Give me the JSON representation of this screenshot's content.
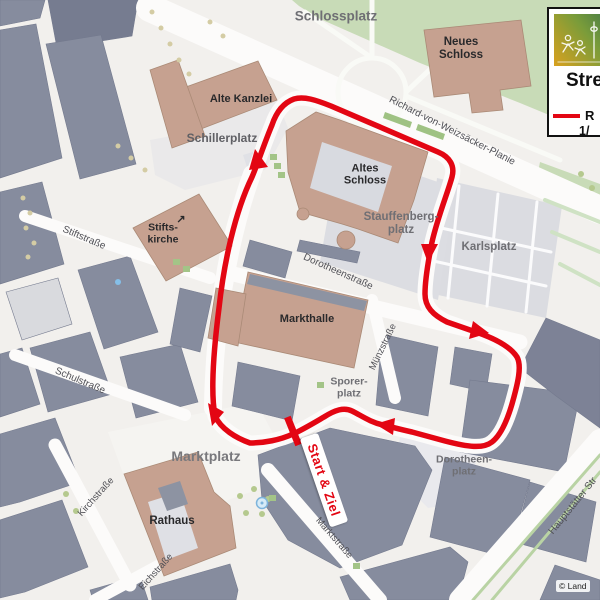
{
  "legend": {
    "logo": "stuttgart-lauf-logo",
    "title": "Stre",
    "route_item": "R",
    "route_item2": "1/",
    "line_color": "#e30613"
  },
  "map": {
    "copyright": "© Land",
    "route_color": "#e30613",
    "start_finish": "Start & Ziel",
    "places": {
      "schlossplatz": "Schlossplatz",
      "neues_schloss": {
        "l1": "Neues",
        "l2": "Schloss"
      },
      "alte_kanzlei": "Alte Kanzlei",
      "schillerplatz": "Schillerplatz",
      "altes_schloss": {
        "l1": "Altes",
        "l2": "Schloss"
      },
      "stauffenbergplatz": {
        "l1": "Stauffenberg-",
        "l2": "platz"
      },
      "karlsplatz": "Karlsplatz",
      "stiftskirche": {
        "l1": "Stifts-",
        "l2": "kirche",
        "icon": "↗"
      },
      "markthalle": "Markthalle",
      "sporerplatz": {
        "l1": "Sporer-",
        "l2": "platz"
      },
      "marktplatz": "Marktplatz",
      "rathaus": "Rathaus",
      "dorotheenplatz": {
        "l1": "Dorotheen-",
        "l2": "platz"
      }
    },
    "streets": {
      "planie": "Richard-von-Weizsäcker-Planie",
      "dorotheenstrasse": "Dorotheenstraße",
      "muenzstrasse": "Münzstraße",
      "marktstrasse": "Marktstraße",
      "stiftstrasse": "Stiftstraße",
      "schulstrasse": "Schulstraße",
      "kirchstrasse": "Kirchstraße",
      "eichstrasse": "Eichstraße",
      "hauptstaetter_strasse": "Hauptstätter Str"
    }
  }
}
